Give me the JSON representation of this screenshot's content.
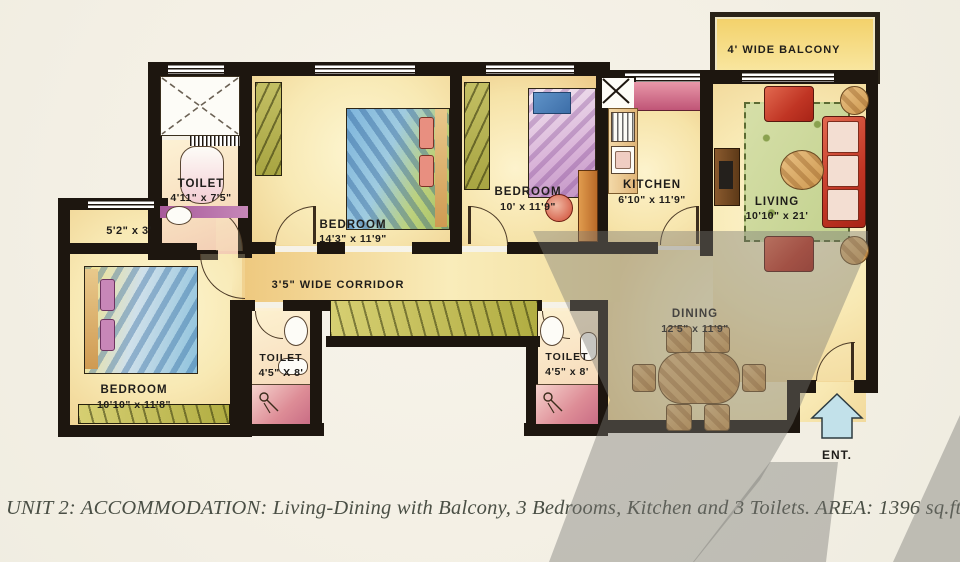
{
  "caption": "UNIT 2: ACCOMMODATION: Living-Dining with Balcony, 3 Bedrooms, Kitchen and 3 Toilets. AREA: 1396 sq.ft.",
  "plan": {
    "balcony": {
      "name": "4' WIDE BALCONY"
    },
    "living": {
      "name": "LIVING",
      "dims": "10'10\" x 21'"
    },
    "kitchen": {
      "name": "KITCHEN",
      "dims": "6'10\" x 11'9\""
    },
    "bedroom_top": {
      "name": "BEDROOM",
      "dims": "10' x 11'9\""
    },
    "bedroom_master": {
      "name": "BEDROOM",
      "dims": "14'3\" x 11'9\""
    },
    "bedroom_left": {
      "name": "BEDROOM",
      "dims": "10'10\" x 11'8\""
    },
    "toilet_top": {
      "name": "TOILET",
      "dims": "4'11\" x 7'5\""
    },
    "toilet_left": {
      "name": "TOILET",
      "dims": "4'5\" X 8'"
    },
    "toilet_right": {
      "name": "TOILET",
      "dims": "4'5\" x 8'"
    },
    "dining": {
      "name": "DINING",
      "dims": "12'5\" x 11'9\""
    },
    "corridor": {
      "name": "3'5\" WIDE CORRIDOR"
    },
    "passage": {
      "dims": "5'2\" x 3'"
    },
    "entrance": {
      "name": "ENT."
    }
  },
  "colors": {
    "wall": "#1d160f",
    "paper": "#f4f1e7",
    "room_cream": "#f9eec2",
    "glow_orange": "#eec173",
    "furniture_red": "#c03524",
    "wardrobe_green": "#b3b14c",
    "rug_green": "#ccd79e",
    "entry_arrow_blue": "#bfe0ea",
    "watermark_gray": "#9b9b95"
  }
}
